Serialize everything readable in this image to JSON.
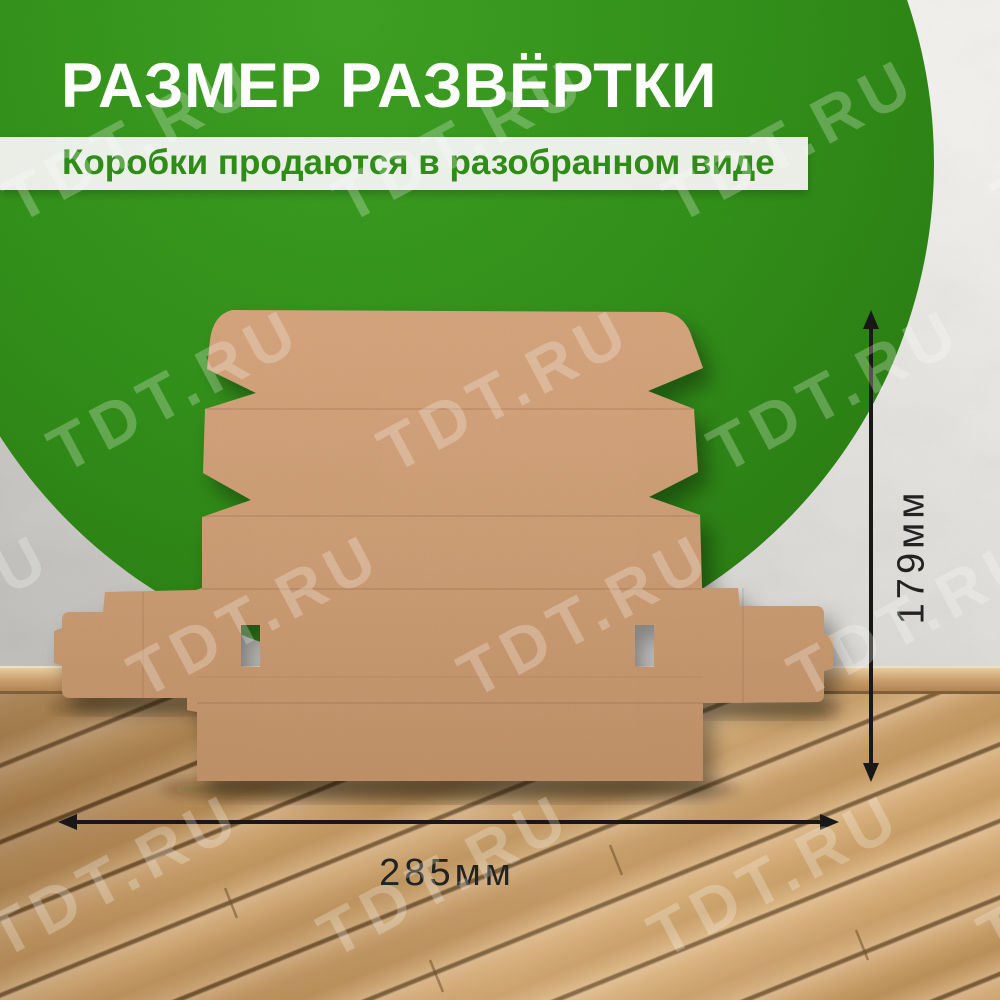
{
  "header": {
    "title": "РАЗМЕР РАЗВЁРТКИ",
    "subtitle": "Коробки продаются в разобранном виде"
  },
  "dimensions": {
    "width": {
      "label": "285мм",
      "value": 285,
      "unit": "мм"
    },
    "height": {
      "label": "179мм",
      "value": 179,
      "unit": "мм"
    }
  },
  "watermark": {
    "text": "TDT.RU"
  },
  "scene": {
    "object": "unfolded-cardboard-mailer-box-blank"
  },
  "colors": {
    "brand_green": "#2e8c17",
    "cardboard": "#cb9a70",
    "wall": "#d6d5d1",
    "floor_wood": "#c99a62",
    "dimension_text": "#222222",
    "title_text": "#ffffff",
    "subtitle_text": "#2e8c17",
    "subtitle_bg": "#f4f4f2"
  }
}
